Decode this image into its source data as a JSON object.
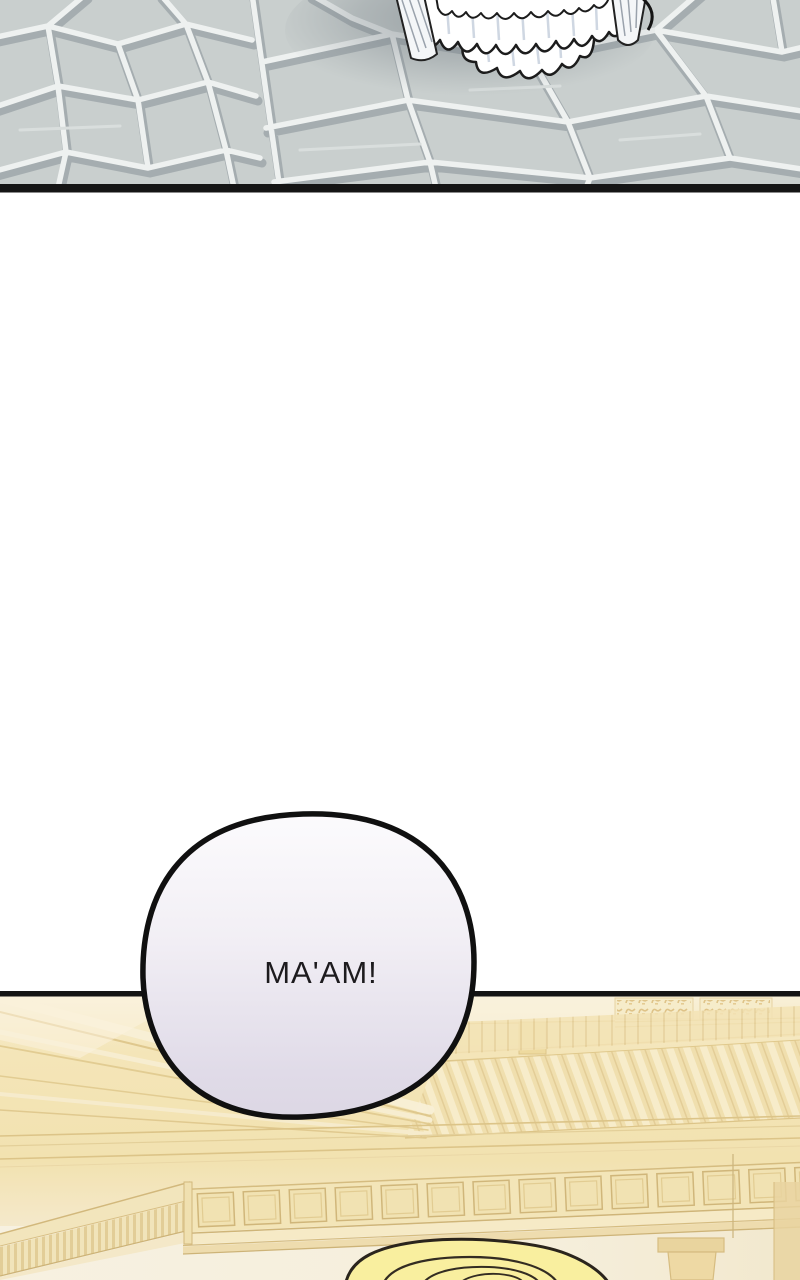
{
  "comic": {
    "bubble": {
      "text": "MA'AM!",
      "text_color": "#1d1b1e",
      "border_color": "#101010",
      "fill_top": "#fcfbfd",
      "fill_bottom": "#dcd7e4"
    },
    "colors": {
      "stone_fill": "#c9cfce",
      "stone_grout": "#eef1f0",
      "stone_shadow": "#9fa7aa",
      "divider_top": "#151515",
      "divider_bottom": "#141414",
      "hall_wash": "#f3e4b6",
      "hall_trim": "#d9c185",
      "hair_fill": "#f9ef9f",
      "hair_outline": "#2a241c",
      "gap_background": "#ffffff"
    }
  }
}
